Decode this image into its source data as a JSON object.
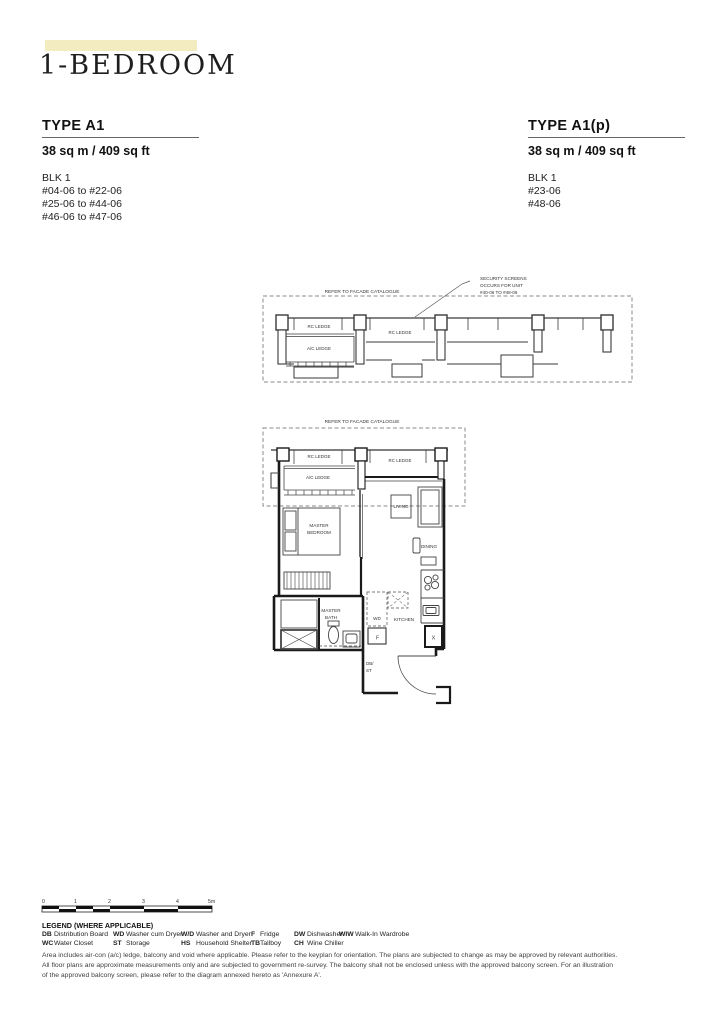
{
  "page_title": "1-BEDROOM",
  "types": {
    "a1": {
      "title": "TYPE A1",
      "area": "38 sq m / 409 sq ft",
      "blk": "BLK 1",
      "units": [
        "#04-06 to #22-06",
        "#25-06 to #44-06",
        "#46-06 to #47-06"
      ]
    },
    "a1p": {
      "title": "TYPE A1(p)",
      "area": "38 sq m / 409 sq ft",
      "blk": "BLK 1",
      "units": [
        "#23-06",
        "#48-06"
      ]
    }
  },
  "facade_section": {
    "note": "REFER TO FACADE CATALOGUE",
    "security_lines": [
      "SECURITY SCREENS",
      "OCCURS FOR UNIT",
      "#40-06 TO #48-06"
    ],
    "rc_ledge_left": "RC LEDGE",
    "rc_ledge_right": "RC LEDGE",
    "ac_ledge": "A/C LEDGE"
  },
  "floor_plan": {
    "note": "REFER TO FACADE CATALOGUE",
    "rc_ledge_left": "RC LEDGE",
    "rc_ledge_right": "RC LEDGE",
    "ac_ledge": "A/C LEDGE",
    "master_bedroom_1": "MASTER",
    "master_bedroom_2": "BEDROOM",
    "living": "LIVING",
    "dining": "DINING",
    "kitchen": "KITCHEN",
    "master_bath_1": "MASTER",
    "master_bath_2": "BATH",
    "wd": "WD",
    "fridge": "F",
    "x_label": "X",
    "dbst_1": "DB/",
    "dbst_2": "ST"
  },
  "scale_bar": {
    "ticks": [
      "0",
      "1",
      "2",
      "3",
      "4",
      "5m"
    ]
  },
  "legend": {
    "title": "LEGEND (WHERE APPLICABLE)",
    "items": [
      {
        "abbr": "DB",
        "desc": "Distribution Board"
      },
      {
        "abbr": "WC",
        "desc": "Water Closet"
      },
      {
        "abbr": "WD",
        "desc": "Washer cum Dryer"
      },
      {
        "abbr": "ST",
        "desc": "Storage"
      },
      {
        "abbr": "W/D",
        "desc": "Washer and Dryer"
      },
      {
        "abbr": "HS",
        "desc": "Household Shelter"
      },
      {
        "abbr": "F",
        "desc": "Fridge"
      },
      {
        "abbr": "TB",
        "desc": "Tallboy"
      },
      {
        "abbr": "DW",
        "desc": "Dishwasher"
      },
      {
        "abbr": "CH",
        "desc": "Wine Chiller"
      },
      {
        "abbr": "WIW",
        "desc": "Walk-In Wardrobe"
      }
    ]
  },
  "disclaimer": "Area includes air-con (a/c) ledge, balcony and void where applicable. Please refer to the keyplan for orientation. The plans are subjected to change as may be approved by relevant authorities. All floor plans are approximate measurements only and are subjected to government re-survey. The balcony shall not be enclosed unless with the approved balcony screen. For an illustration of the approved balcony screen, please refer to the diagram annexed hereto as 'Annexure A'.",
  "colors": {
    "accent_yellow": "#F4ECC1",
    "wall": "#1a1a1a",
    "dashed_line": "#8a8a8a"
  }
}
